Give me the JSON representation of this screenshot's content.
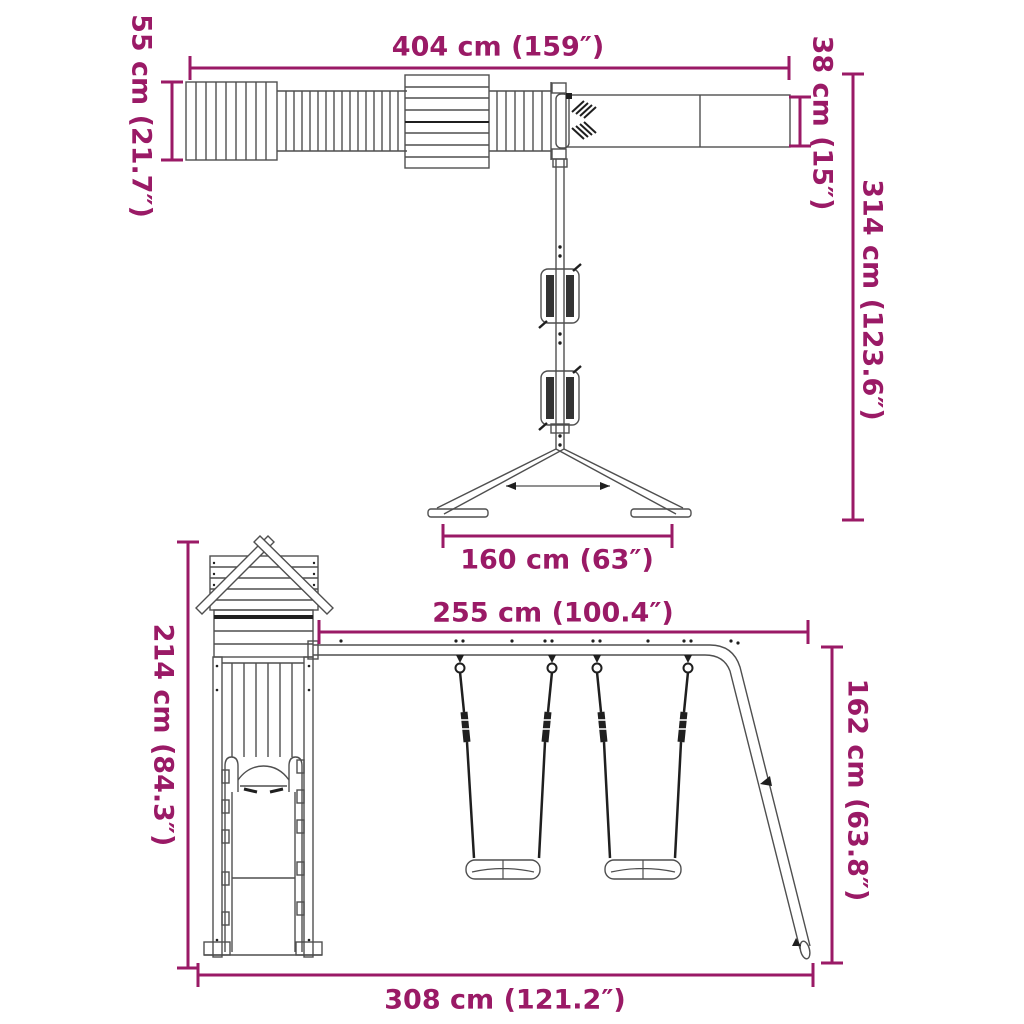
{
  "colors": {
    "dimension_accent": "#9a1a66",
    "structure_outline": "#4f4f4f",
    "structure_dark": "#1f1f1f",
    "background": "#ffffff"
  },
  "diagram": {
    "views": [
      {
        "id": "top-view",
        "dimensions": [
          {
            "id": "overall-length",
            "label": "404 cm (159″)"
          },
          {
            "id": "platform-depth",
            "label": "55 cm (21.7″)"
          },
          {
            "id": "swing-beam-width",
            "label": "38 cm (15″)"
          },
          {
            "id": "overall-depth",
            "label": "314 cm (123.6″)"
          },
          {
            "id": "a-frame-base-width",
            "label": "160 cm (63″)"
          }
        ]
      },
      {
        "id": "front-view",
        "dimensions": [
          {
            "id": "swing-beam-length",
            "label": "255 cm (100.4″)"
          },
          {
            "id": "tower-height",
            "label": "214 cm (84.3″)"
          },
          {
            "id": "swing-frame-height",
            "label": "162 cm (63.8″)"
          },
          {
            "id": "base-length",
            "label": "308 cm (121.2″)"
          }
        ]
      }
    ]
  }
}
